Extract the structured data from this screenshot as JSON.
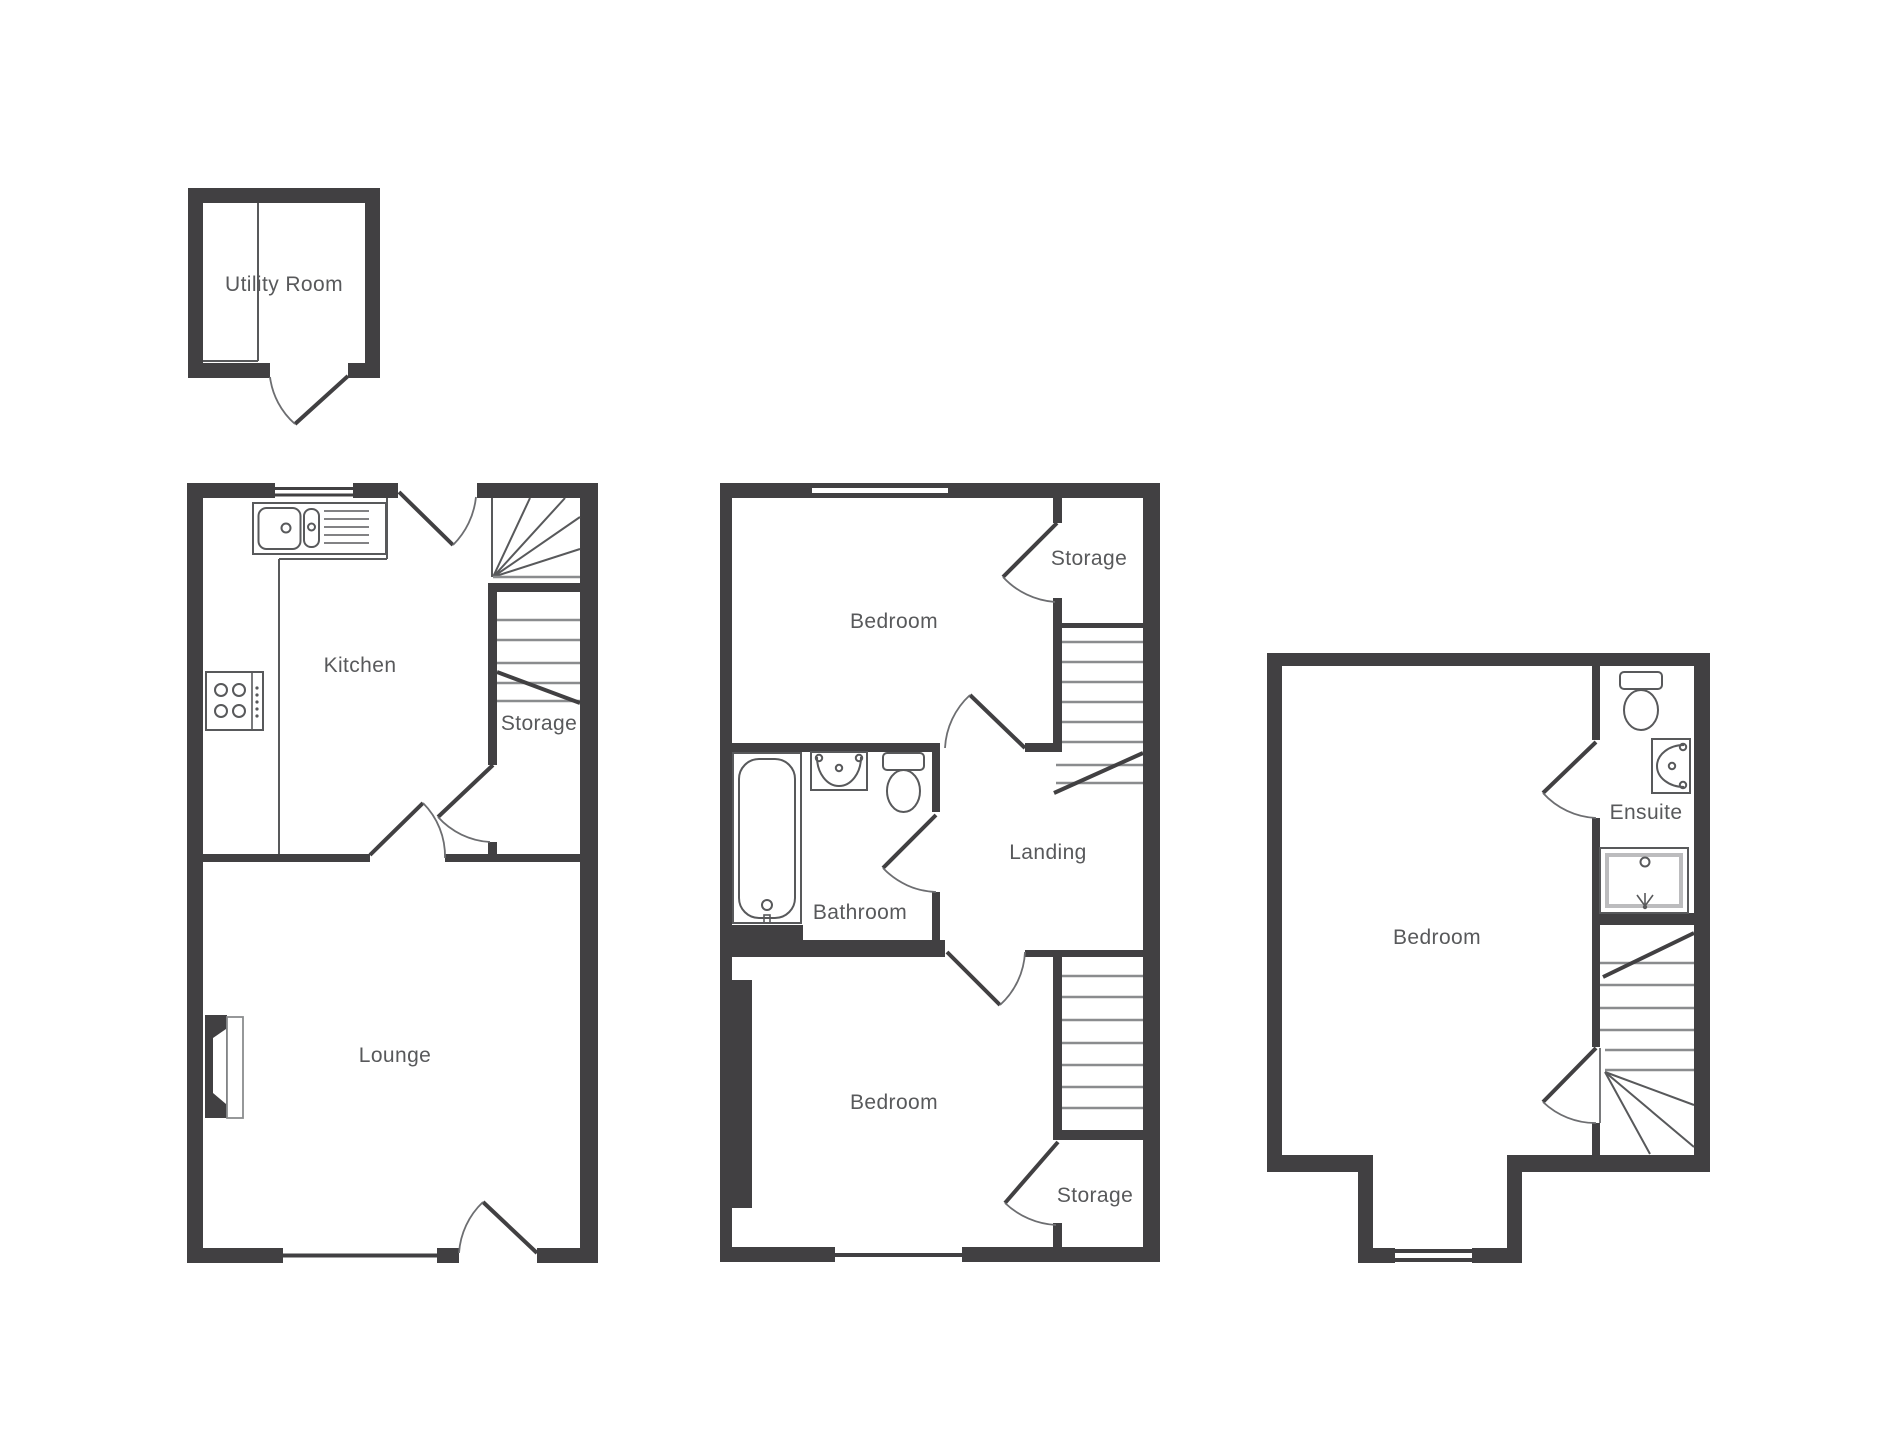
{
  "plan": {
    "background": "#ffffff",
    "colors": {
      "wall": "#414042",
      "line": "#58595b",
      "label": "#58595b",
      "tread": "#8a8c8e",
      "arc": "#6d6e71"
    },
    "floors": {
      "outbuilding": {
        "rooms": [
          {
            "label": "Utility Room"
          }
        ]
      },
      "ground": {
        "rooms": [
          {
            "label": "Kitchen"
          },
          {
            "label": "Storage"
          },
          {
            "label": "Lounge"
          }
        ]
      },
      "first": {
        "rooms": [
          {
            "label": "Bedroom"
          },
          {
            "label": "Storage"
          },
          {
            "label": "Bathroom"
          },
          {
            "label": "Landing"
          },
          {
            "label": "Bedroom"
          },
          {
            "label": "Storage"
          }
        ]
      },
      "second": {
        "rooms": [
          {
            "label": "Bedroom"
          },
          {
            "label": "Ensuite"
          }
        ]
      }
    },
    "fixtures": [
      "kitchen-sink",
      "draining-board",
      "hob",
      "fireplace",
      "bathtub",
      "washbasin",
      "toilet",
      "shower",
      "stairs",
      "door",
      "window"
    ]
  }
}
